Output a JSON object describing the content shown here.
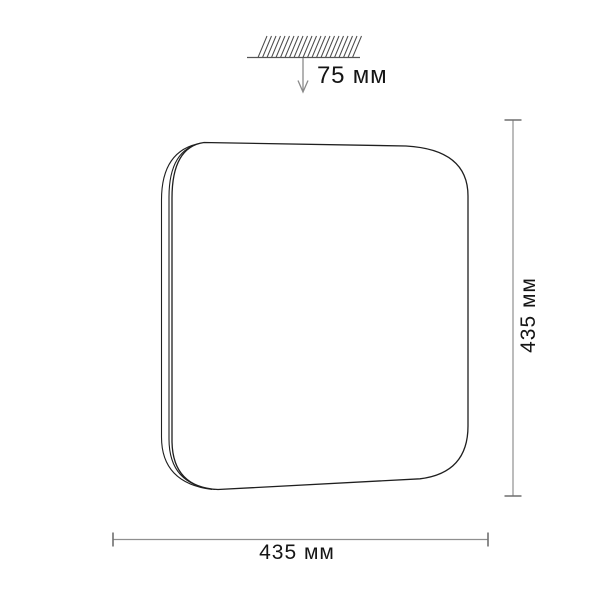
{
  "diagram": {
    "kind": "product-dimension-drawing",
    "subject": "square-ceiling-light-fixture",
    "labels": {
      "ceiling_offset": "75 мм",
      "height": "435 мм",
      "width": "435 мм"
    },
    "values": {
      "ceiling_offset_mm": 75,
      "height_mm": 435,
      "width_mm": 435,
      "unit": "мм"
    },
    "colors": {
      "background": "#ffffff",
      "outline": "#1f1f1f",
      "dimension_line": "#8f8f8f",
      "dimension_cap": "#6f6f6f",
      "hatch": "#4a4a4a",
      "arrow": "#8a8a8a",
      "text": "#151515"
    }
  }
}
